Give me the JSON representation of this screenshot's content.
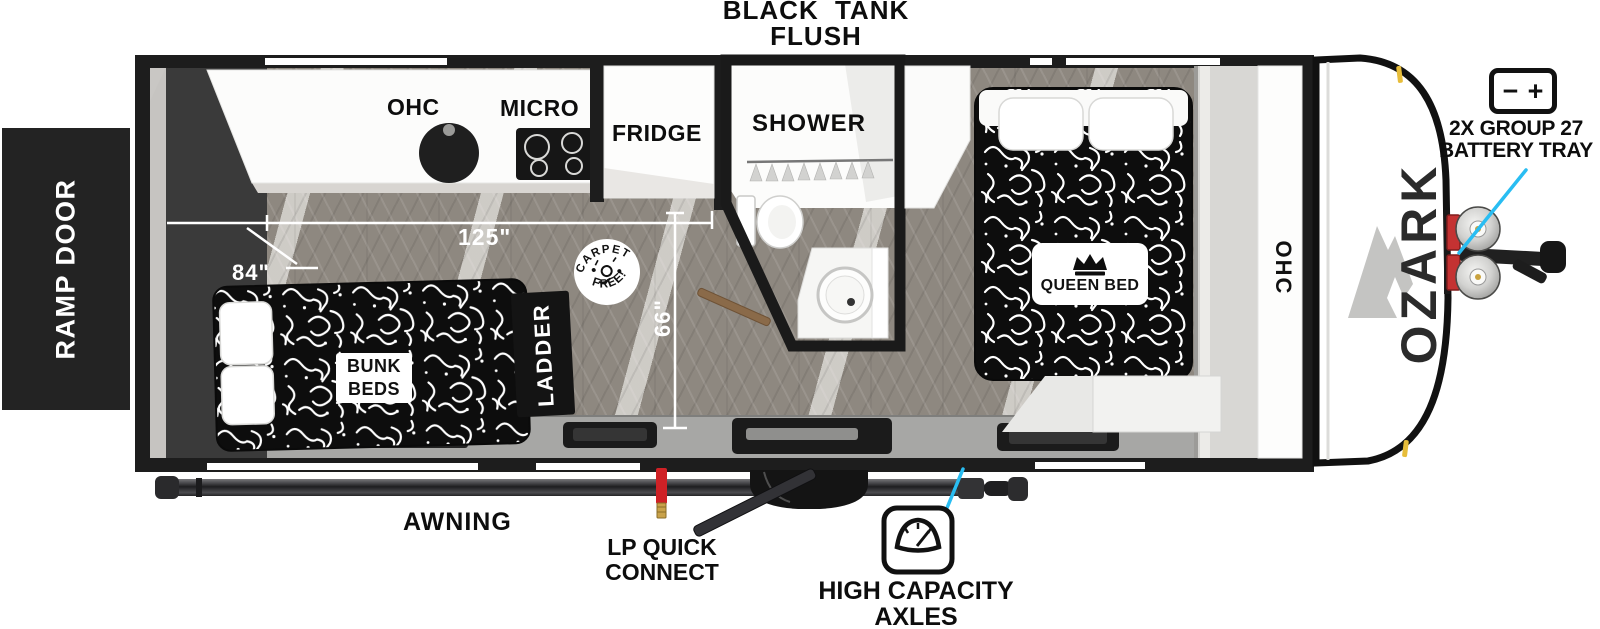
{
  "labels": {
    "black_tank_line1": "BLACK TANK",
    "black_tank_line2": "FLUSH",
    "ramp_door": "RAMP DOOR",
    "kitchen_ohc": "OHC",
    "micro": "MICRO",
    "fridge": "FRIDGE",
    "shower": "SHOWER",
    "bunk_line1": "BUNK",
    "bunk_line2": "BEDS",
    "ladder": "LADDER",
    "queen_bed": "QUEEN BED",
    "front_ohc": "OHC",
    "brand": "OZARK",
    "awning": "AWNING",
    "lp_line1": "LP QUICK",
    "lp_line2": "CONNECT",
    "axles_line1": "HIGH CAPACITY",
    "axles_line2": "AXLES",
    "battery_line1": "2X GROUP 27",
    "battery_line2": "BATTERY TRAY",
    "battery_minus": "−",
    "battery_plus": "+"
  },
  "dimensions": {
    "main_length": "125\"",
    "bunk_width": "84\"",
    "interior_width": "66\""
  },
  "badge": {
    "arc_top": "CARPET",
    "arc_bottom": "FREE!"
  },
  "colors": {
    "accent_cyan": "#29BDF2",
    "wall_black": "#1d1d1d",
    "floor_wood": "#8e8880",
    "deck_gray": "#a7a7a5",
    "bed_fabric": "#0d0d0d",
    "lp_red": "#CF2126",
    "brass": "#C9A24A",
    "marker_yellow": "#E7BD3A"
  }
}
